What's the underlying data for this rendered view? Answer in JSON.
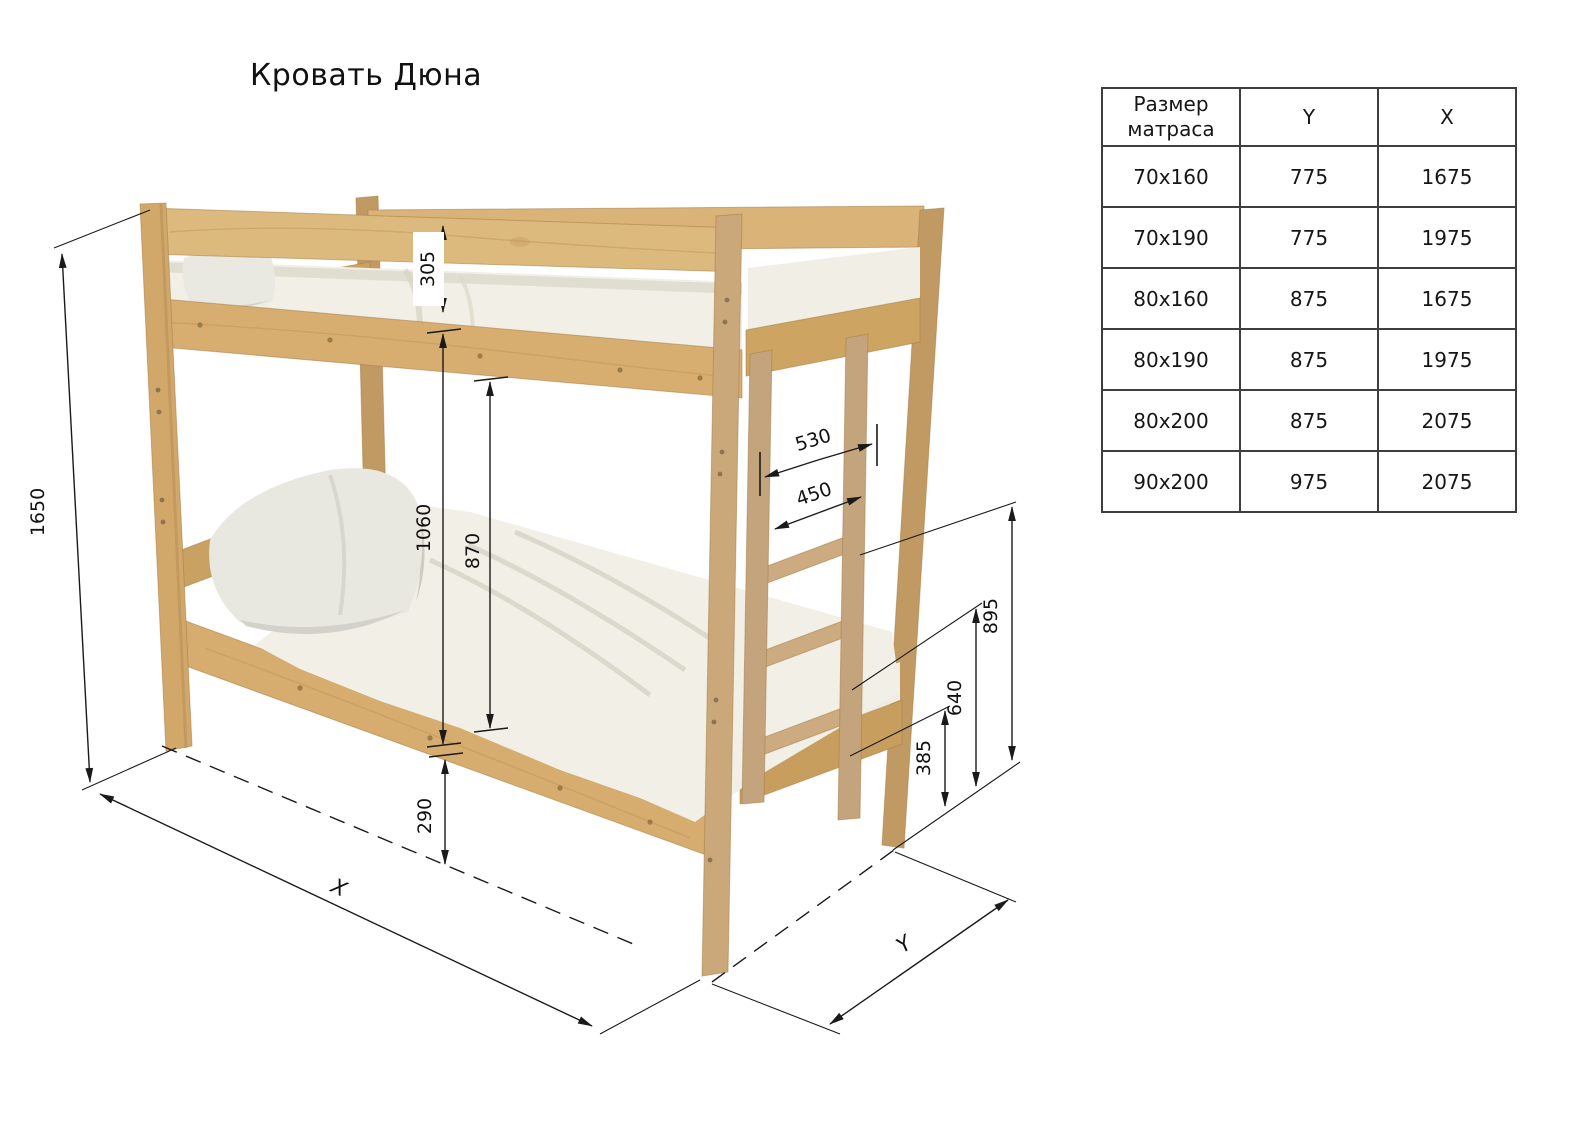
{
  "title": "Кровать Дюна",
  "diagram": {
    "name": "bunk-bed-dimension-drawing",
    "dims": {
      "overall_height": "1650",
      "upper_guard_height": "305",
      "upper_clearance": "1060",
      "under_upper_height": "870",
      "lower_frame_height": "290",
      "ladder_outer_width": "530",
      "ladder_inner_width": "450",
      "rung_top_height": "895",
      "rung_mid_height": "640",
      "rung_low_height": "385",
      "axis_x": "X",
      "axis_y": "Y"
    },
    "colors": {
      "wood_light": "#dfbc80",
      "wood_mid": "#d2a96b",
      "wood_dark": "#bd9459",
      "bedding": "#f2efe6",
      "dimension_line": "#1a1a1a"
    }
  },
  "table": {
    "headers": {
      "size": "Размер\nматраса",
      "y": "Y",
      "x": "X"
    },
    "rows": [
      {
        "size": "70x160",
        "y": "775",
        "x": "1675"
      },
      {
        "size": "70x190",
        "y": "775",
        "x": "1975"
      },
      {
        "size": "80x160",
        "y": "875",
        "x": "1675"
      },
      {
        "size": "80x190",
        "y": "875",
        "x": "1975"
      },
      {
        "size": "80x200",
        "y": "875",
        "x": "2075"
      },
      {
        "size": "90x200",
        "y": "975",
        "x": "2075"
      }
    ]
  }
}
